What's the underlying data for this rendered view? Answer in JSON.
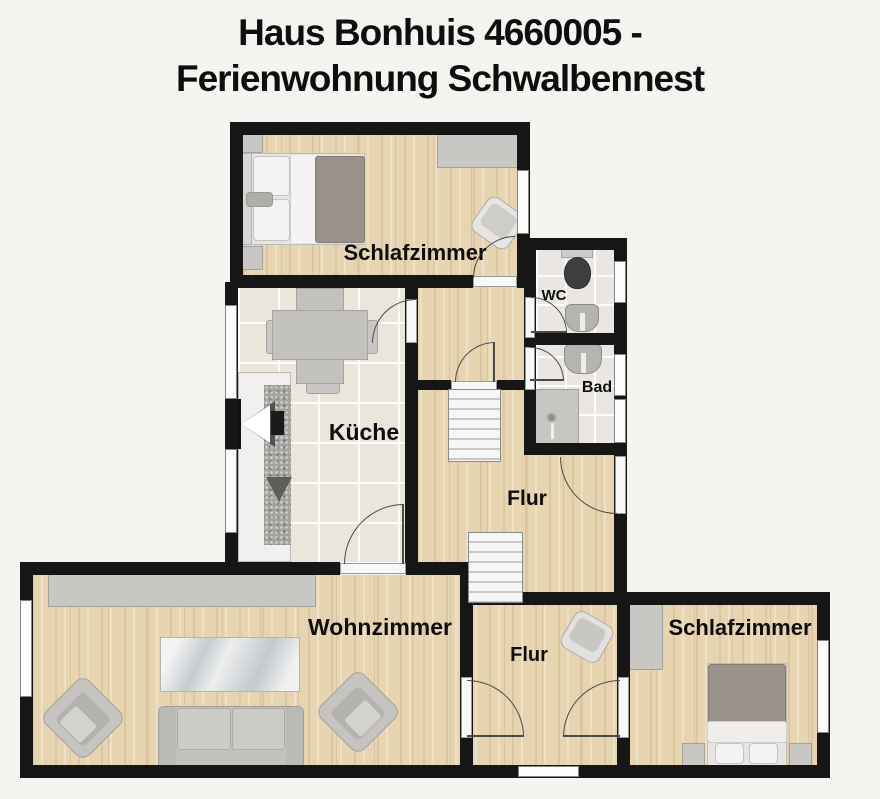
{
  "title": {
    "line1": "Haus Bonhuis 4660005 -",
    "line2": "Ferienwohnung Schwalbennest"
  },
  "rooms": {
    "bedroom_top": {
      "label": "Schlafzimmer"
    },
    "wc": {
      "label": "WC"
    },
    "bathroom": {
      "label": "Bad"
    },
    "kitchen": {
      "label": "Küche"
    },
    "hallway_middle": {
      "label": "Flur"
    },
    "living_room": {
      "label": "Wohnzimmer"
    },
    "hallway_bottom": {
      "label": "Flur"
    },
    "bedroom_bottom": {
      "label": "Schlafzimmer"
    }
  },
  "colors": {
    "background": "#f6f4f1",
    "wall": "#161616",
    "wood_floor": "#e7d4b0",
    "kitchen_tile": "#ebe6dc",
    "bath_tile": "#eae7e2",
    "furniture_gray": "#c9c7c4",
    "duvet_gray": "#9a9189",
    "toilet_seat": "#3e3e3e"
  }
}
